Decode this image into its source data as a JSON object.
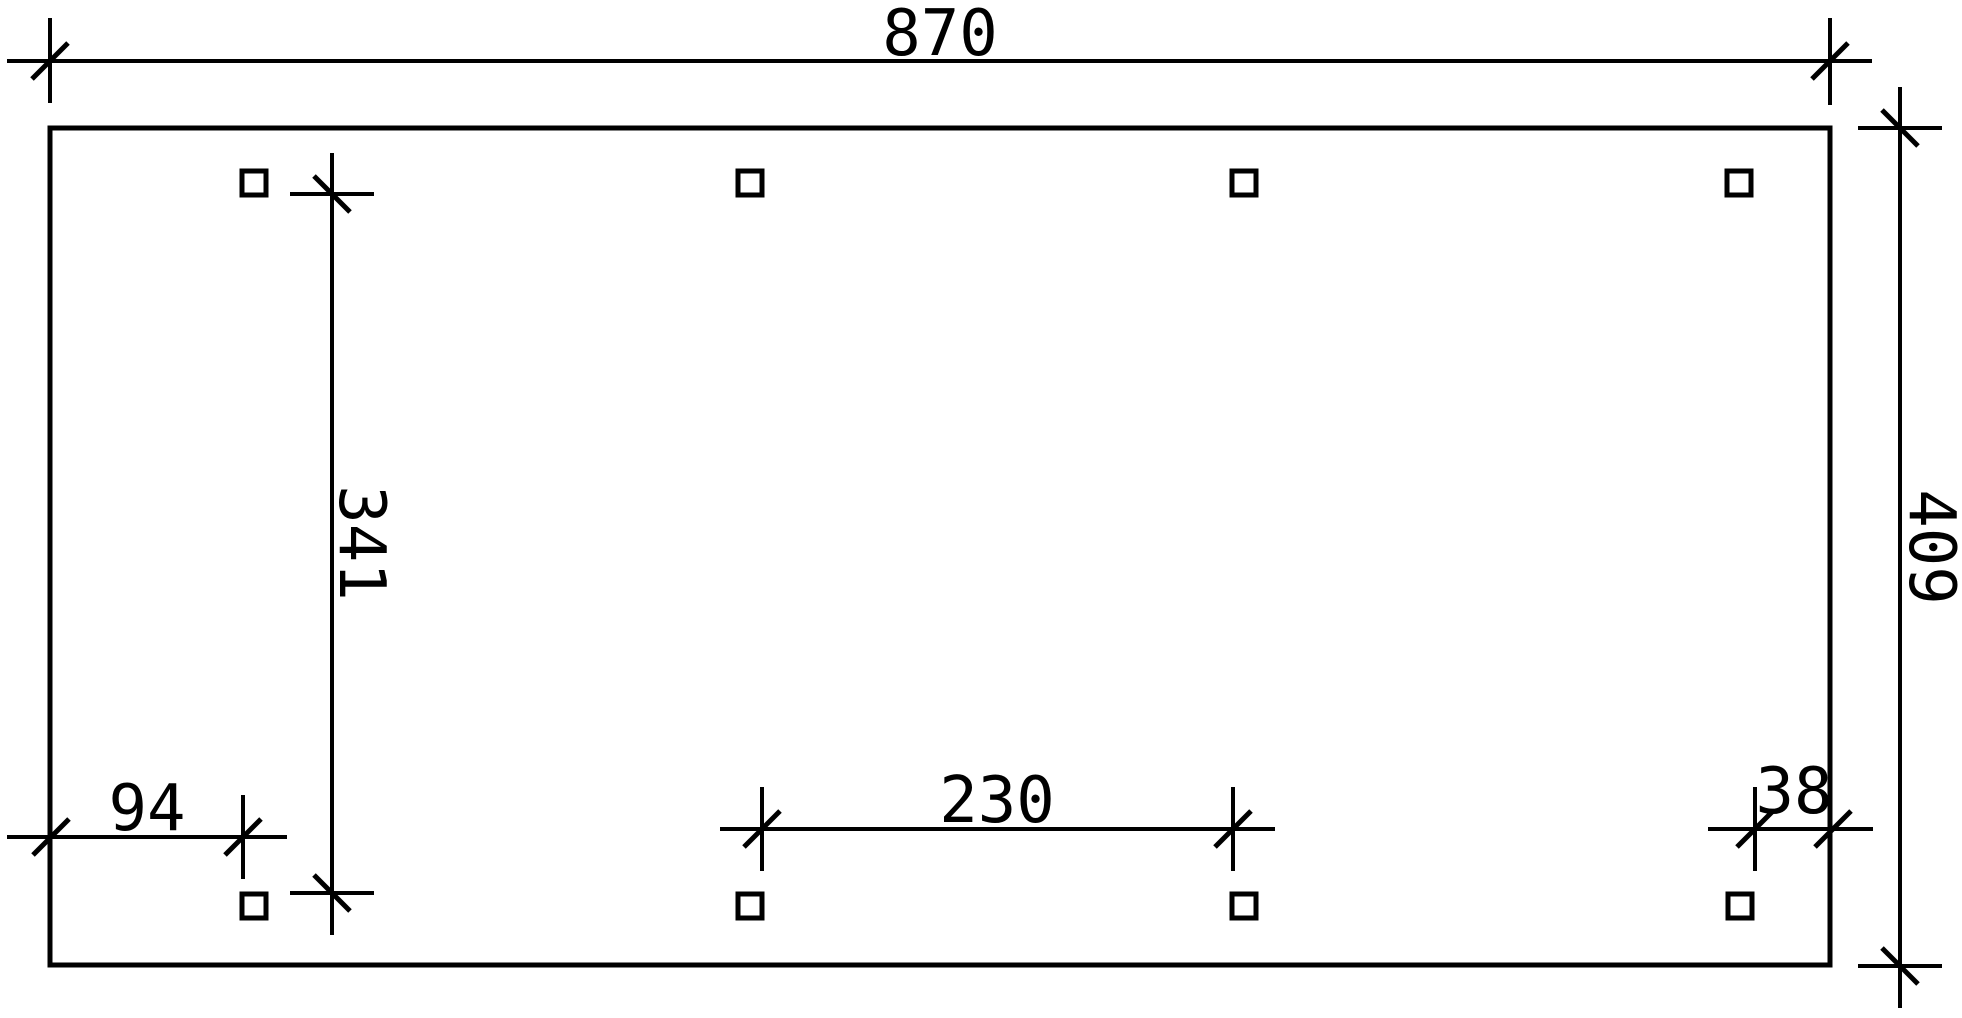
{
  "page": {
    "background": "#ffffff",
    "ink": "#000000"
  },
  "drawing": {
    "type": "technical-plan",
    "outline": {
      "shape": "rectangle"
    },
    "posts": {
      "count": 8,
      "rows": 2,
      "per_row": 4
    },
    "dimensions": [
      {
        "id": "overall-width",
        "label": "870",
        "orientation": "horizontal",
        "position": "top"
      },
      {
        "id": "overall-depth",
        "label": "409",
        "orientation": "vertical",
        "position": "right"
      },
      {
        "id": "post-row-span",
        "label": "341",
        "orientation": "vertical",
        "position": "interior-left"
      },
      {
        "id": "left-post-offset",
        "label": "94",
        "orientation": "horizontal",
        "position": "bottom-left"
      },
      {
        "id": "post-bay-spacing",
        "label": "230",
        "orientation": "horizontal",
        "position": "bottom-center"
      },
      {
        "id": "right-post-offset",
        "label": "38",
        "orientation": "horizontal",
        "position": "bottom-right"
      }
    ]
  }
}
